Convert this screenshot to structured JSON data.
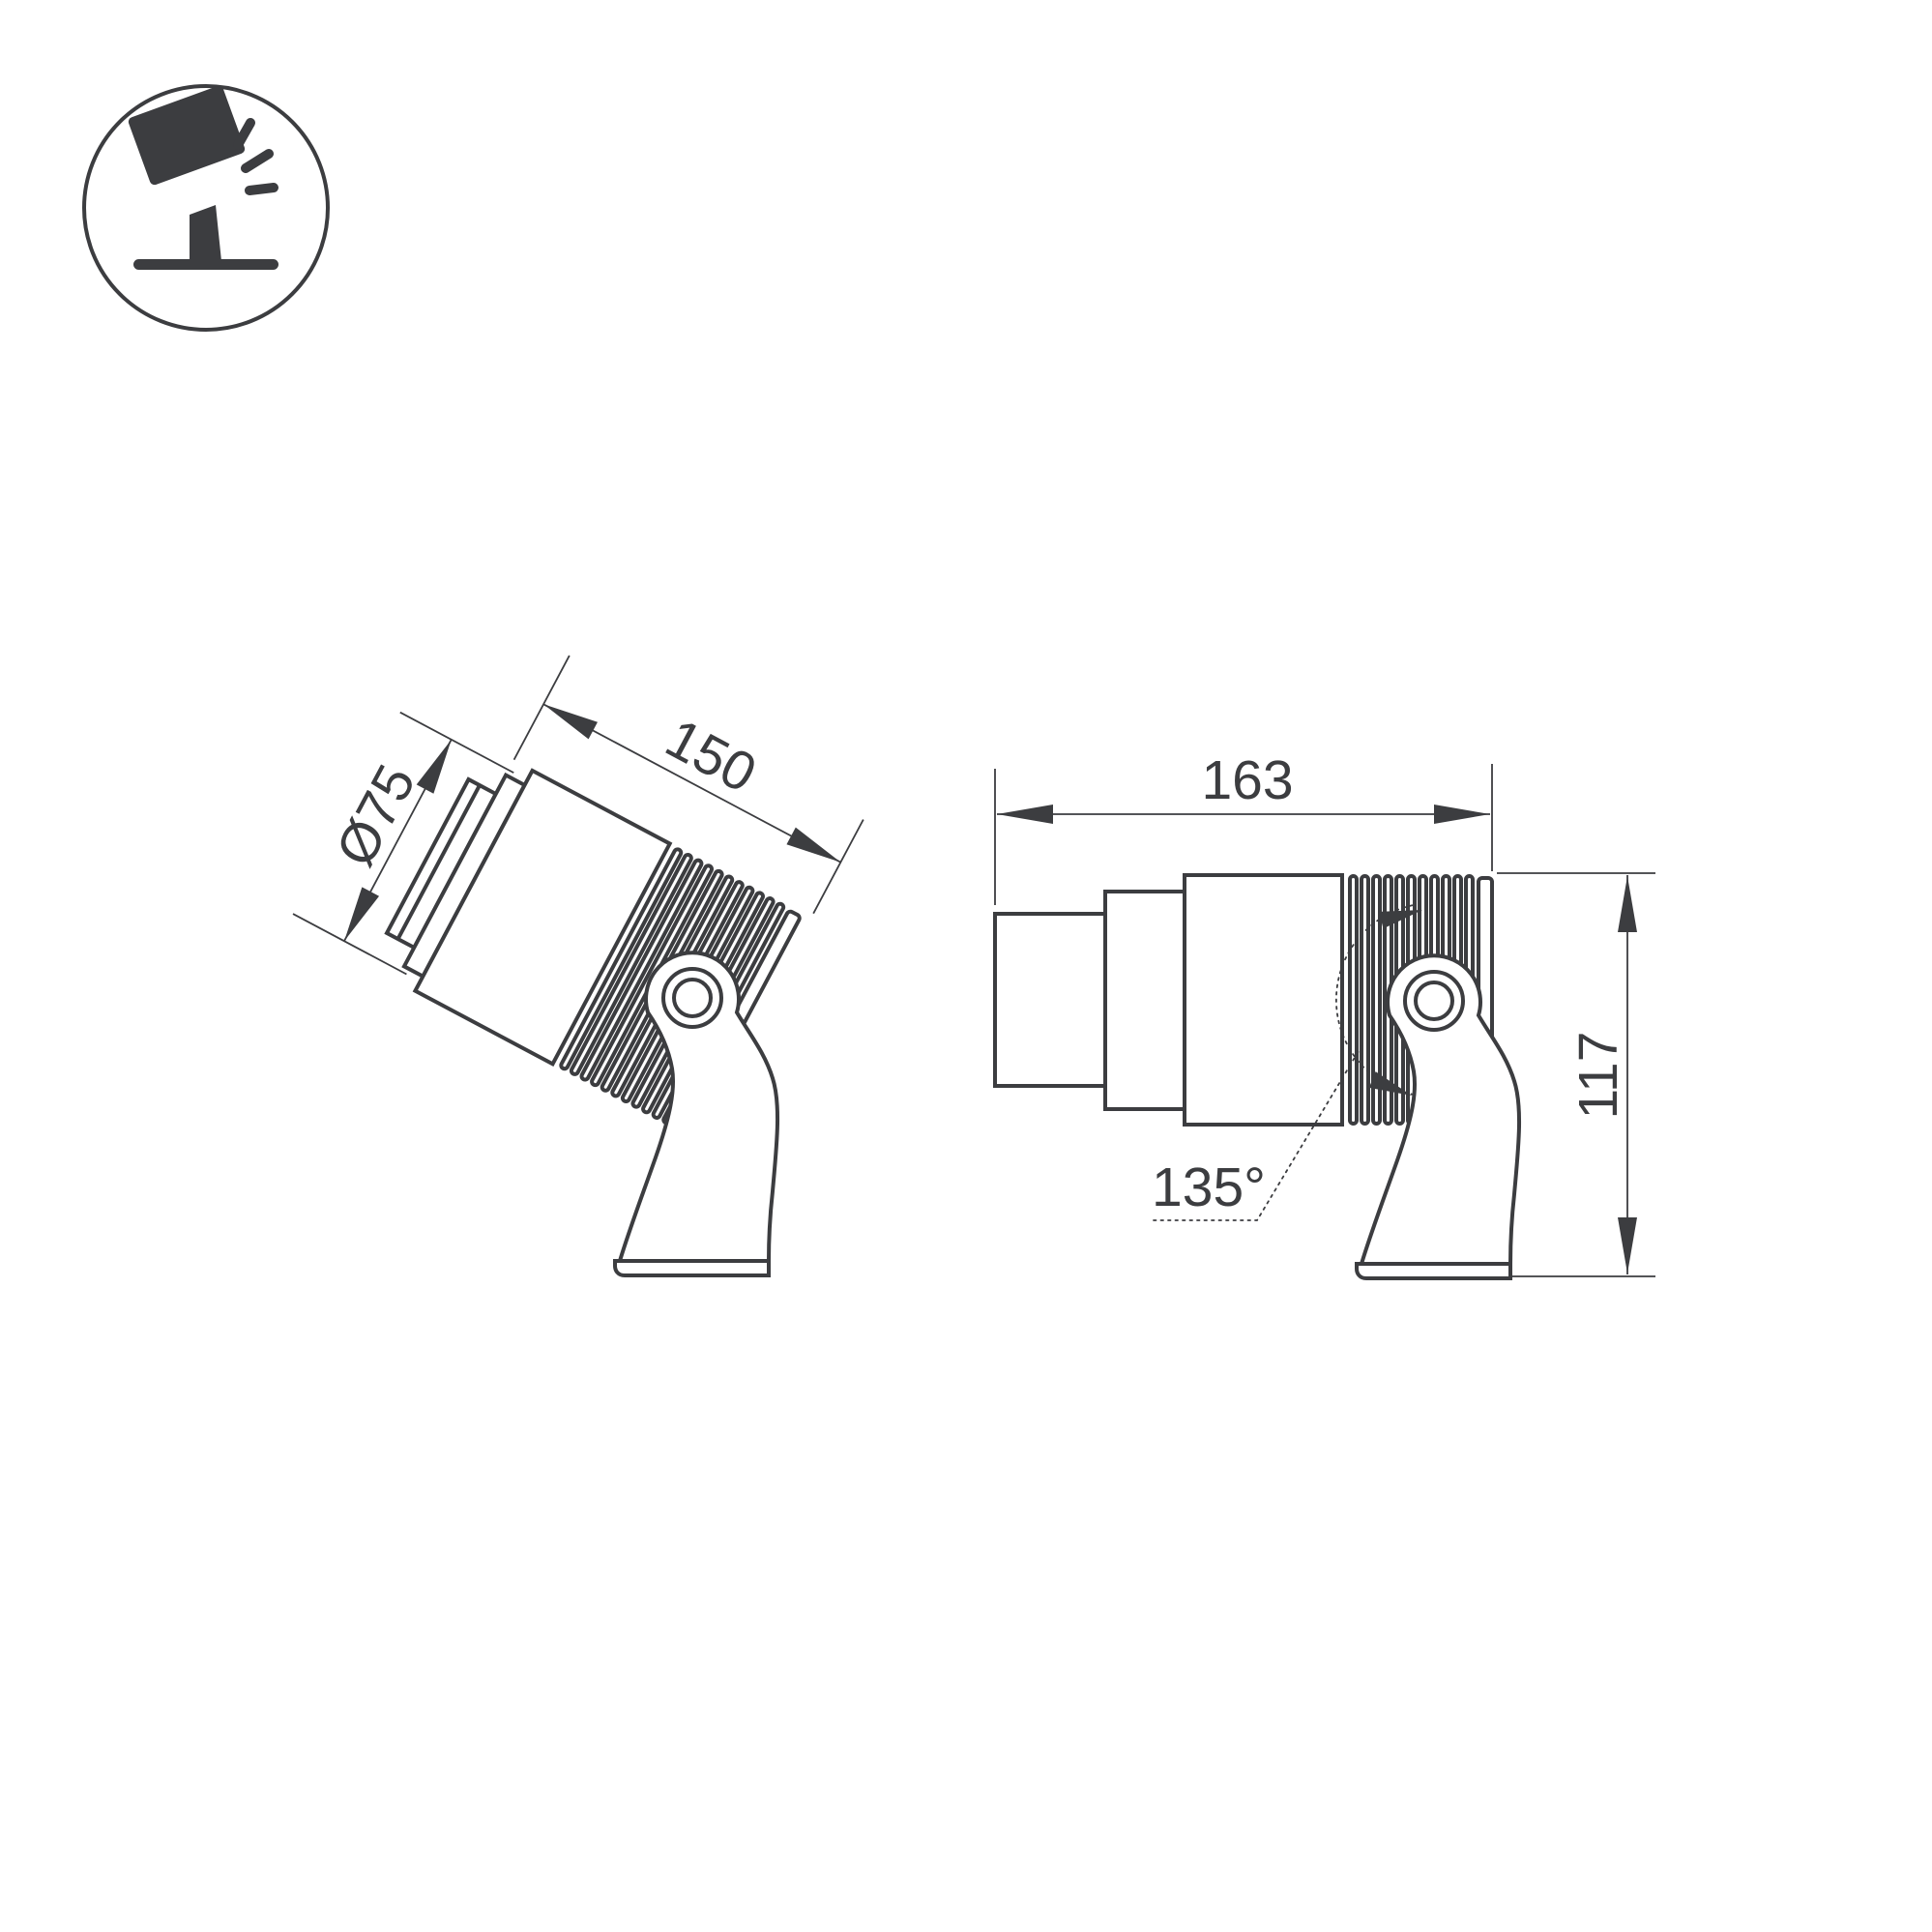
{
  "meta": {
    "background_color": "#ffffff",
    "line_color": "#3c3d40",
    "drawing_type": "spotlight-dimension-diagram"
  },
  "icon": {
    "name": "tilted-spotlight-on-stand-with-light-rays"
  },
  "views": {
    "left": {
      "description": "tilted view of spotlight on mounting bracket",
      "diameter_label": "Ø75",
      "length_label": "150"
    },
    "right": {
      "description": "side view of spotlight on mounting bracket",
      "width_label": "163",
      "height_label": "117",
      "angle_label": "135°"
    }
  }
}
